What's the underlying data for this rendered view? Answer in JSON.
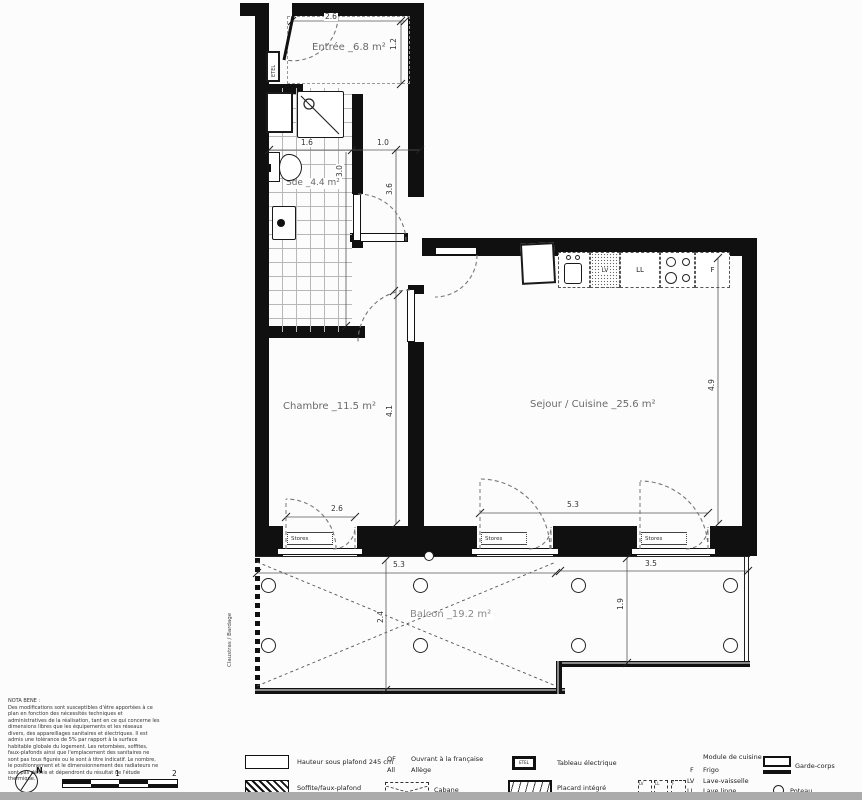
{
  "plan": {
    "rooms": {
      "entree": "Entrée _6.8 m²",
      "sde": "Sde _4.4 m²",
      "chambre": "Chambre _11.5 m²",
      "sejour": "Sejour / Cuisine _25.6 m²",
      "balcon": "Balcon _19.2 m²"
    },
    "dims": {
      "entree_w": "2.6",
      "entree_d": "1.2",
      "sde_w": "1.6",
      "hall_w": "1.0",
      "sde_h": "3.0",
      "hall_h": "3.6",
      "chambre_h": "4.1",
      "chambre_win": "2.6",
      "sejour_win": "5.3",
      "sejour_h": "4.9",
      "balcon_left_w": "5.3",
      "balcon_right_w": "3.5",
      "balcon_left_d": "2.4",
      "balcon_right_d": "1.9"
    },
    "labels": {
      "etel": "ETEL",
      "stores": "Stores",
      "lv": "LV",
      "ll": "LL",
      "f": "F",
      "claustras": "Claustras / Bardage"
    }
  },
  "notabene": {
    "title": "NOTA BENE :",
    "body": "Des modifications sont susceptibles d'être apportées à ce plan en fonction des nécessités techniques et administratives de la réalisation, tant en ce qui concerne les dimensions libres que les équipements et les réseaux divers, des appareillages sanitaires et électriques. Il est admis une tolérance de 5% par rapport à la surface habitable globale du logement. Les retombées, soffites, faux-plafonds ainsi que l'emplacement des sanitaires ne sont pas tous figurés ou le sont à titre indicatif. Le nombre, le positionnement et le dimensionnement des radiateurs ne sont pas définis et dépendront du résultat de l'étude thermique."
  },
  "compass": {
    "north": "N"
  },
  "scalebar": {
    "one": "1",
    "two": "2"
  },
  "legend": {
    "ceiling": "Hauteur sous plafond 245 cm",
    "of_abbr": "OF",
    "of": "Ouvrant à la française",
    "all_abbr": "All",
    "all": "Allège",
    "etel": "ETEL",
    "tableau": "Tableau électrique",
    "soffite": "Soffite/faux-plafond",
    "cabane": "Cabane",
    "placard": "Placard intégré",
    "module_title": "Module de cuisine",
    "f_abbr": "F",
    "f": "Frigo",
    "lv_abbr": "LV",
    "lv": "Lave-vaisselle",
    "ll_abbr": "LL",
    "ll": "Lave linge",
    "garde": "Garde-corps",
    "poteau": "Poteau",
    "mod_lv": "LV",
    "mod_ll": "LL",
    "mod_f": "F"
  }
}
